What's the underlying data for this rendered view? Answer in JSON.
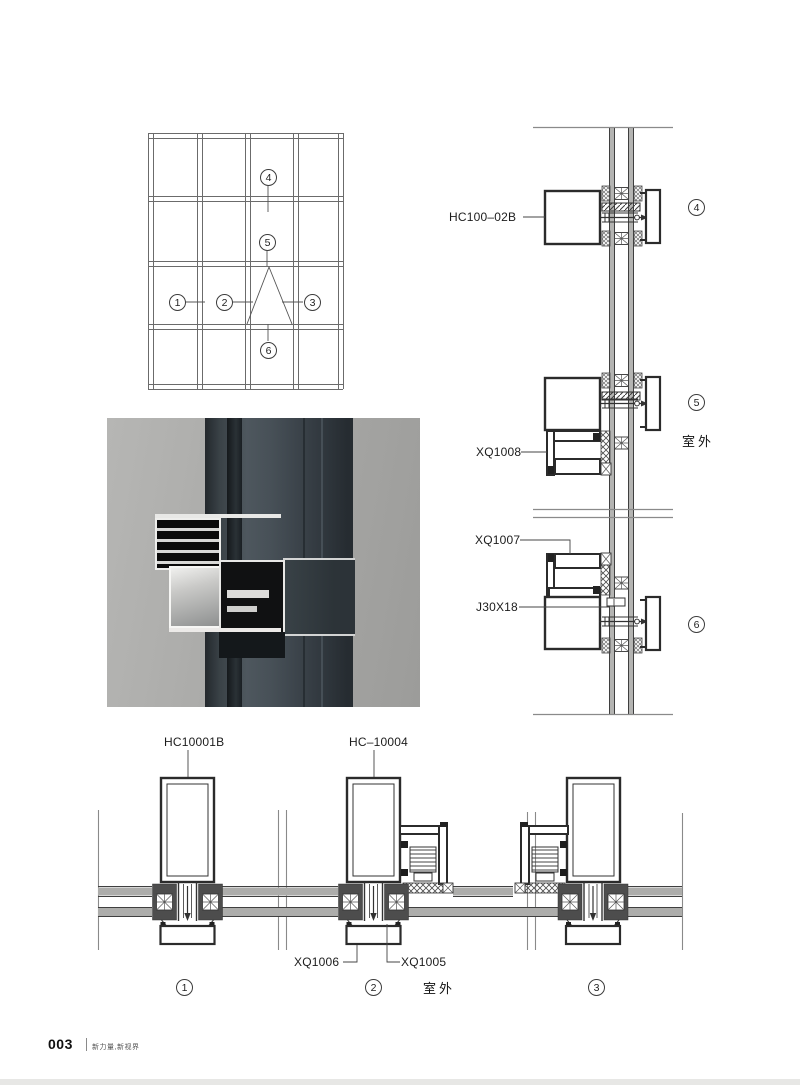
{
  "page": {
    "number": "003",
    "slogan": "新力量,新视界"
  },
  "labels": {
    "hc100_02b": "HC100–02B",
    "xq1008": "XQ1008",
    "xq1007": "XQ1007",
    "j30x18": "J30X18",
    "hc10001b": "HC10001B",
    "hc_10004": "HC–10004",
    "xq1006": "XQ1006",
    "xq1005": "XQ1005",
    "outdoor": "室外"
  },
  "callouts": {
    "n1": "1",
    "n2": "2",
    "n3": "3",
    "n4": "4",
    "n5": "5",
    "n6": "6"
  }
}
